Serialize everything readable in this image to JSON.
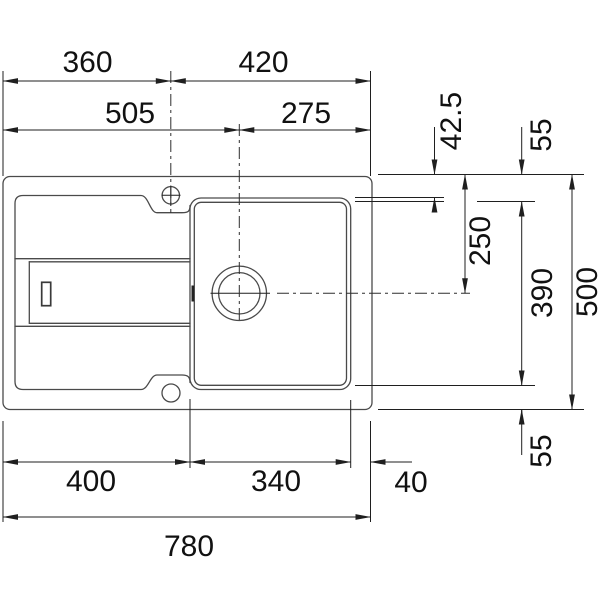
{
  "colors": {
    "background": "#ffffff",
    "body_line": "#4a4a4a",
    "dim_line": "#1f1f1f",
    "text": "#111111"
  },
  "dims": {
    "top_left_width": "360",
    "top_right_width": "420",
    "second_left_width": "505",
    "second_right_width": "275",
    "right_edge_to_bowl": "42.5",
    "right_top_margin": "55",
    "right_edge_to_drain": "250",
    "right_bowl_depth": "390",
    "right_total_depth": "500",
    "right_bottom_margin": "55",
    "bottom_left_width": "400",
    "bottom_bowl_width": "340",
    "bottom_right_margin": "40",
    "bottom_total_width": "780"
  }
}
